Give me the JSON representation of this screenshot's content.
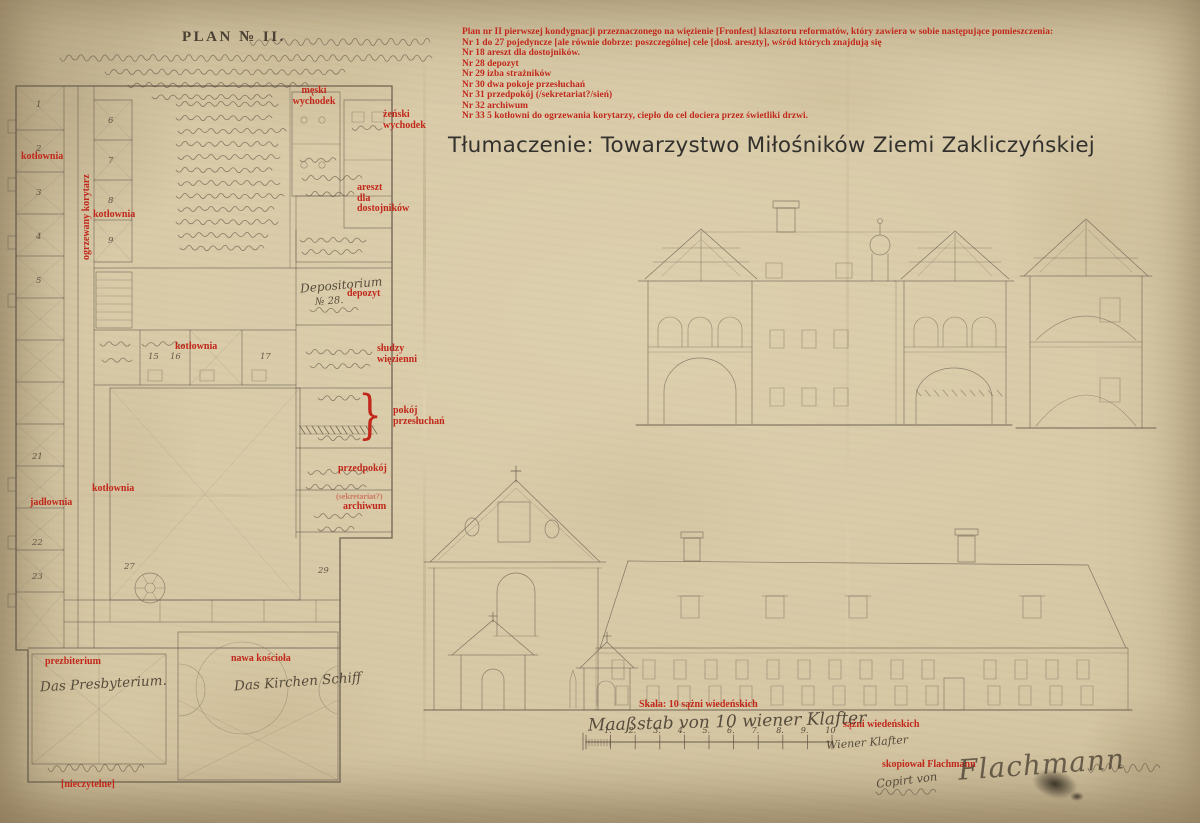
{
  "document": {
    "translation_credit": "Tłumaczenie: Towarzystwo Miłośników Ziemi Zakliczyńskiej"
  },
  "colors": {
    "annotation_red": "#c1281b",
    "paper": "#d6c7a4",
    "ink": "#6b5f52"
  },
  "legend": {
    "lines": [
      "Plan nr II pierwszej kondygnacji przeznaczonego na więzienie [Fronfest] klasztoru reformatów, który zawiera w sobie następujące pomieszczenia:",
      "Nr 1 do 27 pojedyncze [ale równie dobrze: poszczególne] cele [dosł. areszty], wśród których znajdują się",
      "Nr 18 areszt dla dostojników.",
      "Nr 28 depozyt",
      "Nr 29 izba strażników",
      "Nr 30 dwa pokoje przesłuchań",
      "Nr 31 przedpokój (/sekretariat?/sień)",
      "Nr 32 archiwum",
      "Nr 33 5 kotłowni do ogrzewania korytarzy, ciepło do cel dociera przez świetliki drzwi."
    ]
  },
  "annotations": {
    "meski_wychodek": "męski\nwychodek",
    "zenski_wychodek": "żeński\nwychodek",
    "areszt_dla_dostojnikow": "areszt\ndla\ndostojników",
    "kotlownia_gorna": "kotłownia",
    "ogrzewany_korytarz": "ogrzewany korytarz",
    "kotlownia_druga": "kotłownia",
    "depozyt": "depozyt",
    "kotlownia_srodkowa": "kotłownia",
    "sludzy_wiezienni": "słudzy\nwięzienni",
    "brace": "}",
    "pokoj_przesluchan": "pokój\nprzesłuchań",
    "przedpokoj": "przedpokój",
    "sekretariat": "(sekretariat?)",
    "archiwum": "archiwum",
    "kotlownia_dolna": "kotłownia",
    "jadlownia": "jadłownia",
    "prezbiterium": "prezbiterium",
    "nawa_kosciola": "nawa kościoła",
    "nieczytelne": "[nieczytelne]",
    "skala": "Skala: 10 sążni wiedeńskich",
    "sazni_wiedenskich": "sążni wiedeńskich",
    "skopiowal": "skopiował Flachmann"
  },
  "handwriting": {
    "plan_title": "PLAN № II.",
    "depositorium": "Depositorium",
    "depositorium_no": "№ 28.",
    "presbyterium": "Das Presbyterium.",
    "kirchenschiff": "Das Kirchen Schiff",
    "maasstab": "Maaßstab von 10 wiener Klafter",
    "wiener_klafter": "Wiener Klafter",
    "copirt_von": "Copirt von",
    "flachmann_signature": "Flachmann"
  },
  "scale": {
    "numbers": [
      "1.",
      "2.",
      "3.",
      "4.",
      "5.",
      "6.",
      "7.",
      "8.",
      "9.",
      "10"
    ]
  },
  "plan": {
    "cell_numbers": [
      "1",
      "2",
      "3",
      "4",
      "5",
      "6",
      "7",
      "8",
      "9",
      "15",
      "16",
      "17",
      "21",
      "22",
      "23",
      "27",
      "29"
    ]
  }
}
